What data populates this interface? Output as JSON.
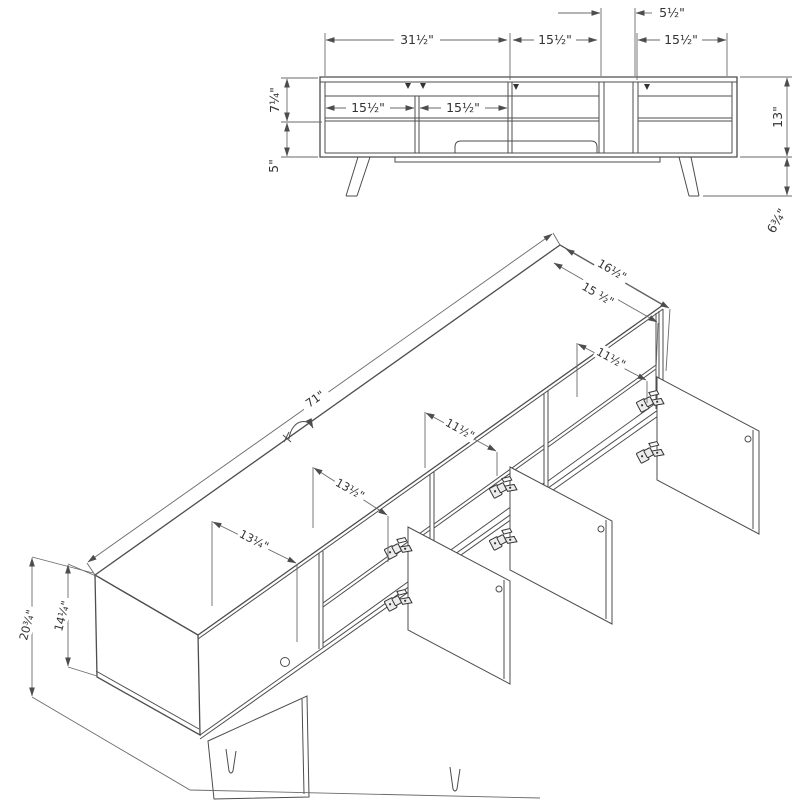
{
  "diagram": {
    "title": "tv-stand-assembly-dimension-drawing",
    "front": {
      "dims": {
        "slot_width": "5½\"",
        "left_section_width": "31½\"",
        "mid_section_width": "15½\"",
        "right_section_width": "15½\"",
        "inner_left_width": "15½\"",
        "inner_right_width": "15½\"",
        "upper_height": "7¼\"",
        "lower_height": "5\"",
        "body_height": "13\"",
        "leg_height": "6¾\""
      }
    },
    "iso": {
      "dims": {
        "total_width": "71\"",
        "top_depth": "16½\"",
        "inner_depth": "15 ½\"",
        "right_opening_depth": "11½\"",
        "mid_opening_depth": "11½\"",
        "opening_depth_b": "13½\"",
        "opening_depth_a": "13¼\"",
        "total_height": "20¾\"",
        "body_height": "14¼\""
      }
    }
  }
}
